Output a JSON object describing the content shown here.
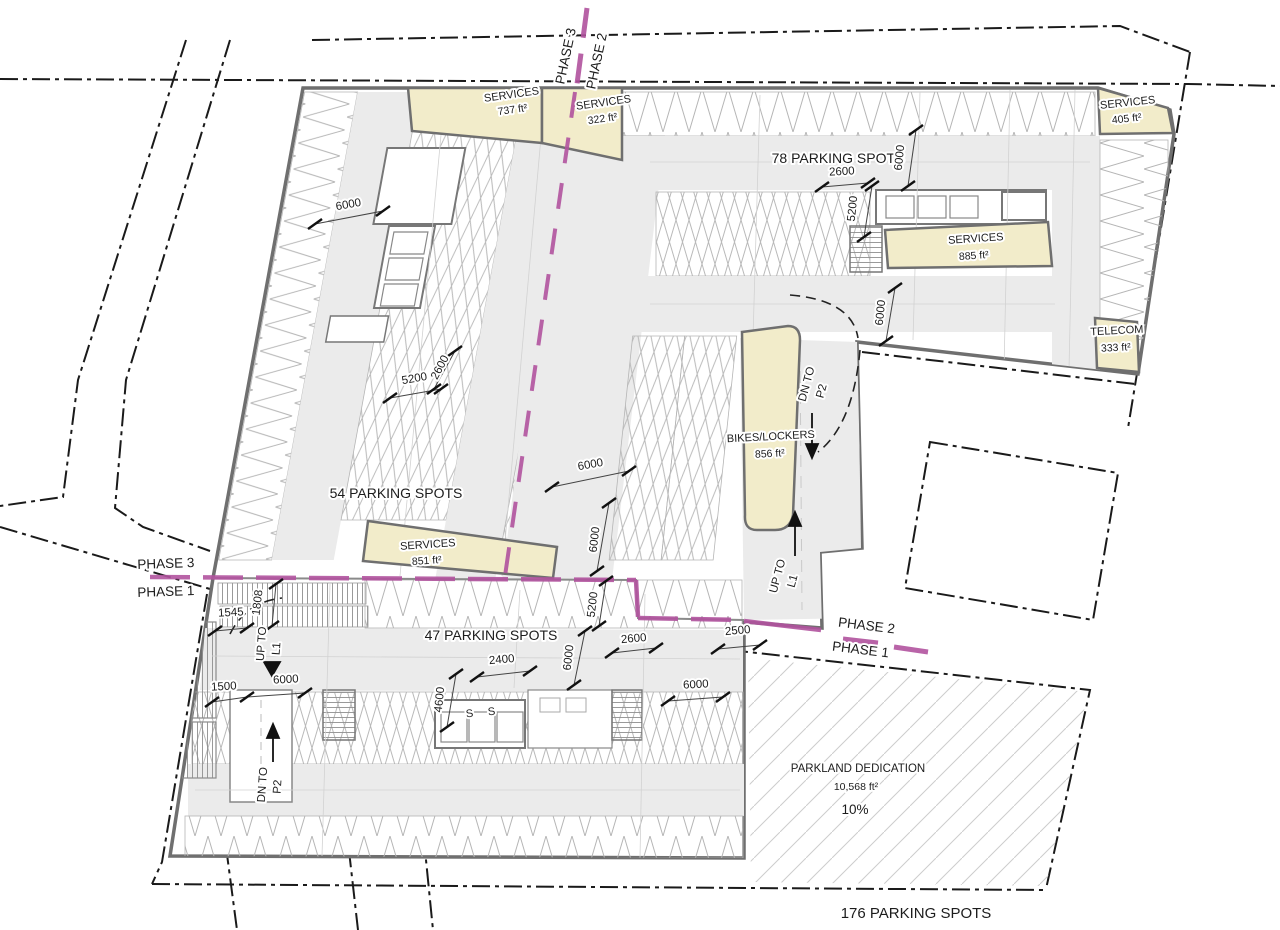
{
  "phase_lines": {
    "top": {
      "a": "PHASE 3",
      "b": "PHASE 2"
    },
    "left": {
      "a": "PHASE 3",
      "b": "PHASE 1"
    },
    "right": {
      "a": "PHASE 2",
      "b": "PHASE 1"
    }
  },
  "rooms": {
    "services_737": {
      "name": "SERVICES",
      "area": "737 ft²"
    },
    "services_322": {
      "name": "SERVICES",
      "area": "322 ft²"
    },
    "services_405": {
      "name": "SERVICES",
      "area": "405 ft²"
    },
    "services_885": {
      "name": "SERVICES",
      "area": "885 ft²"
    },
    "services_851": {
      "name": "SERVICES",
      "area": "851 ft²"
    },
    "telecom": {
      "name": "TELECOM",
      "area": "333 ft²"
    },
    "bikes": {
      "name": "BIKES/LOCKERS",
      "area": "856 ft²"
    }
  },
  "parking": {
    "count_78": "78 PARKING SPOTS",
    "count_54": "54 PARKING SPOTS",
    "count_47": "47 PARKING SPOTS",
    "count_total": "176 PARKING SPOTS"
  },
  "parkland": {
    "title": "PARKLAND DEDICATION",
    "area": "10,568 ft²",
    "percent": "10%"
  },
  "circulation": {
    "dn_p2_upper": {
      "l1": "DN TO",
      "l2": "P2"
    },
    "up_l1_right": {
      "l1": "UP TO",
      "l2": "L1"
    },
    "up_l1_left": {
      "l1": "UP TO",
      "l2": "L1"
    },
    "dn_p2_lower": {
      "l1": "DN TO",
      "l2": "P2"
    },
    "stall_s": "S"
  },
  "dims": [
    "6000",
    "5200",
    "2600",
    "6000",
    "6000",
    "5200",
    "2600",
    "6000",
    "2400",
    "4600",
    "6000",
    "6000",
    "1500",
    "1545",
    "1808",
    "2500",
    "2600",
    "6000",
    "5200",
    "6000"
  ],
  "colors": {
    "phase_line": "#b1539e",
    "service_room": "#f2ecca",
    "aisle": "#ebebeb",
    "wall": "#6f6f6f",
    "stall_line": "#b5b5b5",
    "hatch": "#cdcdcd"
  }
}
